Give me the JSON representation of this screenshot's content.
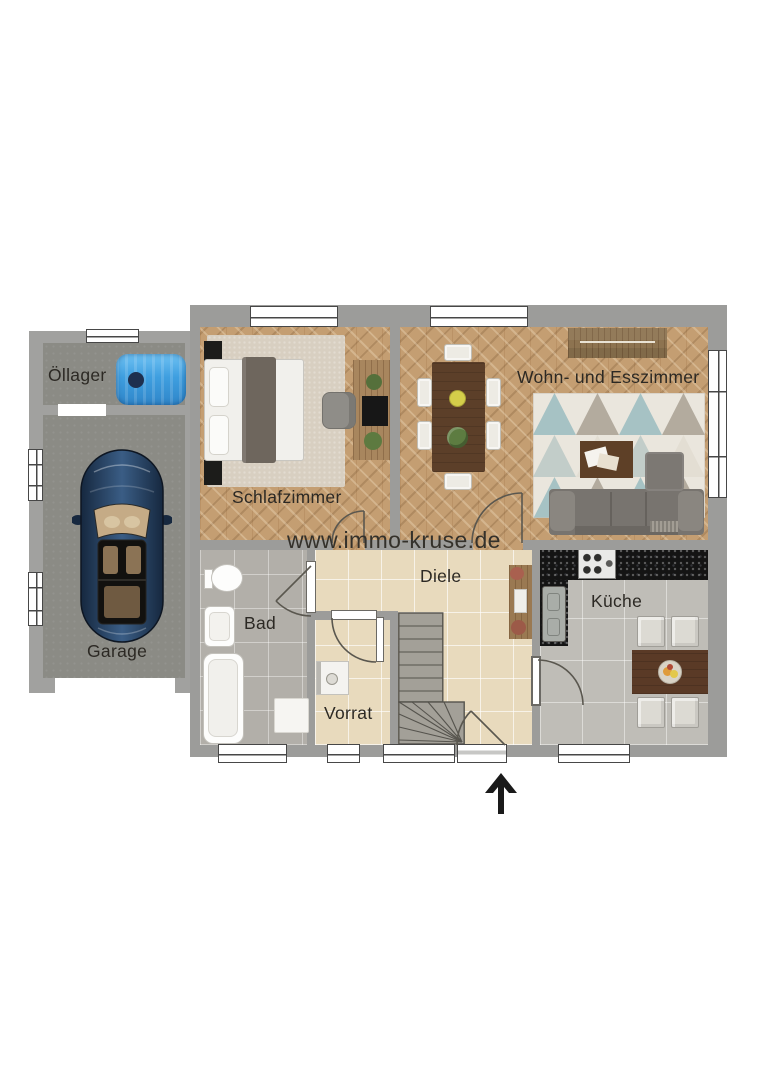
{
  "watermark": {
    "text": "www.immo-kruse.de"
  },
  "rooms": {
    "oellager": {
      "label": "Öllager"
    },
    "garage": {
      "label": "Garage"
    },
    "schlafzimmer": {
      "label": "Schlafzimmer"
    },
    "wohn_esszimmer": {
      "label": "Wohn- und Esszimmer"
    },
    "bad": {
      "label": "Bad"
    },
    "diele": {
      "label": "Diele"
    },
    "vorrat": {
      "label": "Vorrat"
    },
    "kueche": {
      "label": "Küche"
    }
  },
  "compass": {
    "direction": "north",
    "symbol": "up-arrow"
  },
  "palette": {
    "wall_grey": "#9c9c9a",
    "wood_floor": "#c49e72",
    "tile_beige": "#e8dabd",
    "tile_bath_grey": "#b2afa9",
    "tile_kitchen_grey": "#bfbdb7",
    "garage_concrete": "#8b8b85",
    "oil_tank_blue": "#3f9fe0",
    "kitchen_counter_black": "#141414",
    "sofa_grey": "#78746f",
    "dining_table_brown": "#5c3f29",
    "rug_teal": "#a6c2c4",
    "car_blue": "#24405f",
    "label_text": "#2c2924"
  }
}
